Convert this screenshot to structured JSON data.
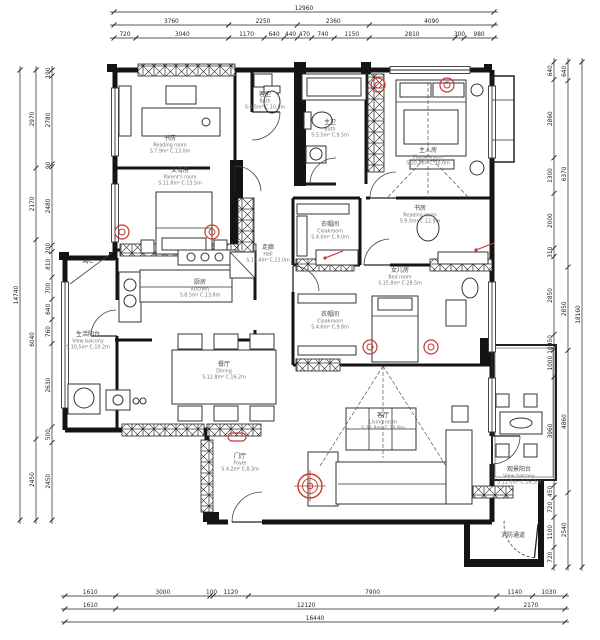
{
  "sheet": {
    "colors": {
      "wall": "#141414",
      "line": "#3a3a3a",
      "text": "#555555",
      "accent_red": "#c23b30"
    }
  },
  "rooms": [
    {
      "id": "reading-room-1",
      "cn": "书房",
      "en": "Reading room",
      "area": "S.7.9m²  C.13.0m"
    },
    {
      "id": "parents-room",
      "cn": "父母房",
      "en": "Parent's room",
      "area": "S.11.8m² C.13.5m"
    },
    {
      "id": "guest-bath",
      "cn": "客卫",
      "en": "Bath",
      "area": "S.4.5m²  C.10.5m"
    },
    {
      "id": "master-bath",
      "cn": "主卫",
      "en": "Bath",
      "area": "S.5.5m²  C.9.5m"
    },
    {
      "id": "master-room",
      "cn": "主人房",
      "en": "Master room",
      "area": "S.20.8m² C.30.0m"
    },
    {
      "id": "cloakroom-1",
      "cn": "衣帽间",
      "en": "Cloakroom",
      "area": "S.4.0m²  C.9.0m"
    },
    {
      "id": "reading-room-2",
      "cn": "书房",
      "en": "Reading room",
      "area": "S.9.5m²  C.12.9m"
    },
    {
      "id": "daughter-room",
      "cn": "女儿房",
      "en": "Bed room",
      "area": "S.15.8m² C.28.5m"
    },
    {
      "id": "cloakroom-2",
      "cn": "衣帽间",
      "en": "Cloakroom",
      "area": "S.4.6m²  C.9.8m"
    },
    {
      "id": "kitchen",
      "cn": "厨房",
      "en": "Kitchen",
      "area": "S.8.5m²  C.13.8m"
    },
    {
      "id": "hall",
      "cn": "走廊",
      "en": "Hall",
      "area": "S.12.4m² C.22.0m"
    },
    {
      "id": "dining",
      "cn": "餐厅",
      "en": "Dining",
      "area": "S.12.8m² C.16.2m"
    },
    {
      "id": "service-balcony",
      "cn": "生活阳台",
      "en": "View balcony",
      "area": "S.10.5m² C.10.2m"
    },
    {
      "id": "foyer",
      "cn": "门厅",
      "en": "Foyer",
      "area": "S.4.2m²  C.8.3m"
    },
    {
      "id": "living-room",
      "cn": "客厅",
      "en": "Living room",
      "area": "S.36.8m² C.25.8m"
    },
    {
      "id": "view-balcony",
      "cn": "观景阳台",
      "en": "View balcony",
      "area": "S.11.0m² C.26.3m"
    },
    {
      "id": "fire-corridor",
      "cn": "消防通道",
      "en": "",
      "area": ""
    }
  ],
  "annotations": {
    "ac": "A/C"
  },
  "dimensions": {
    "top": {
      "overall": [
        "12960"
      ],
      "major": [
        "3760",
        "2250",
        "2360",
        "4090"
      ],
      "minor": [
        "720",
        "3040",
        "1170",
        "640",
        "440",
        "470",
        "740",
        "1150",
        "2810",
        "300",
        "980"
      ]
    },
    "bottom": {
      "minor": [
        "1610",
        "3000",
        "100",
        "1120",
        "7900",
        "1140",
        "1030"
      ],
      "major": [
        "1610",
        "12120",
        "2170"
      ],
      "overall": [
        "16440"
      ]
    },
    "left": {
      "overall": [
        "14740"
      ],
      "major": [
        "2970",
        "2170",
        "6040",
        "2450"
      ],
      "minor": [
        "190",
        "2780",
        "90",
        "2480",
        "200",
        "810",
        "700",
        "640",
        "760",
        "2630",
        "500",
        "2450"
      ]
    },
    "right": {
      "overall": [
        "18160"
      ],
      "major": [
        "640",
        "6370",
        "2850",
        "4860",
        "2540"
      ],
      "minor": [
        "640",
        "2860",
        "1300",
        "2000",
        "310",
        "2850",
        "450",
        "100",
        "1000",
        "3960",
        "450",
        "720",
        "1100",
        "720"
      ]
    }
  }
}
